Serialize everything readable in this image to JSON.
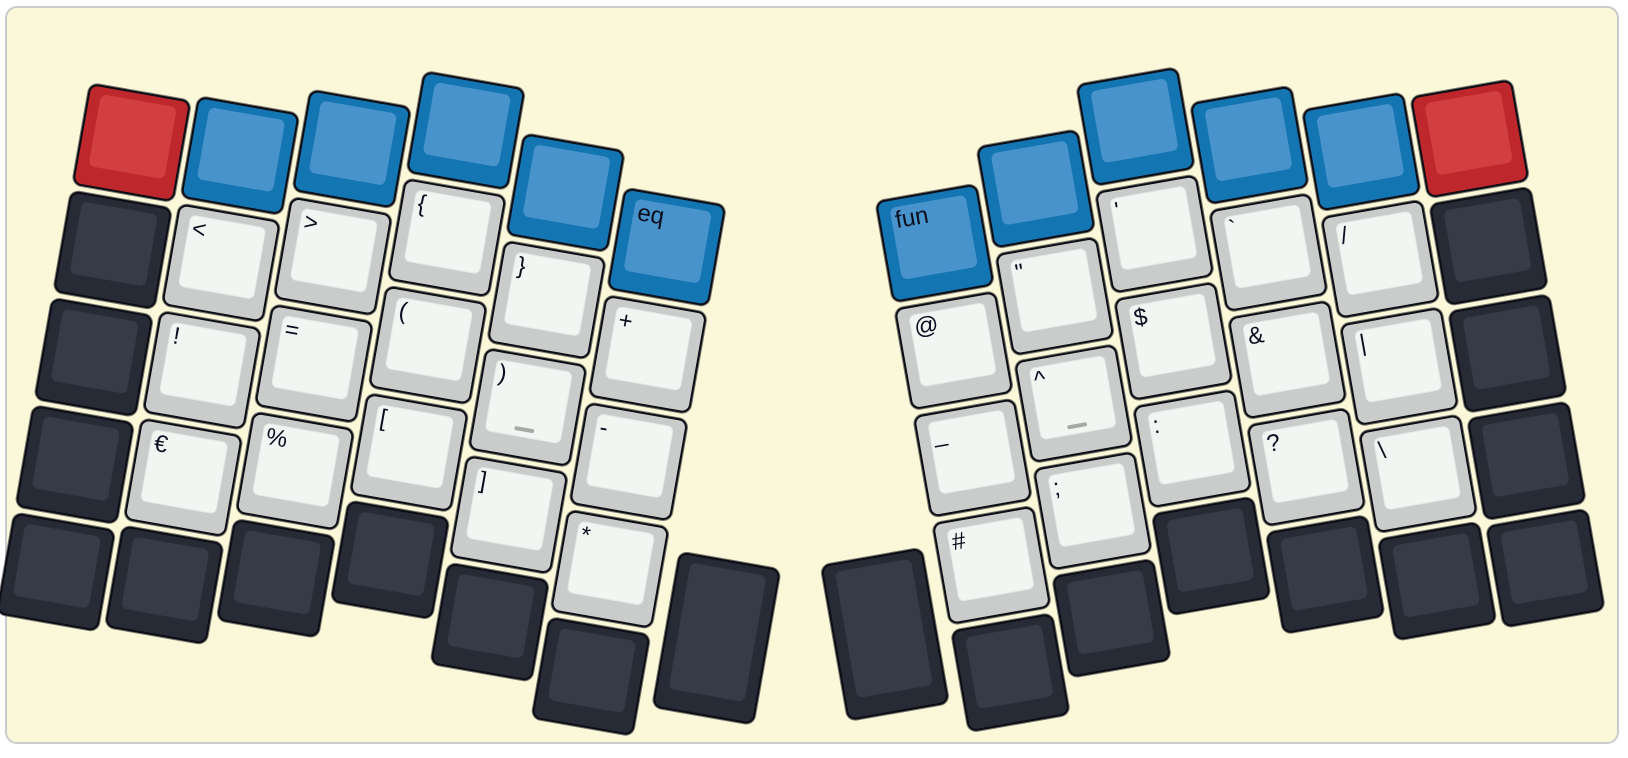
{
  "app": {
    "description": "Split ergonomic keyboard layout diagram (symbols layer), two rotated halves on a pale-yellow keyboard case"
  },
  "case": {
    "fill": "#FBF8D9",
    "border": "#C9CBCE",
    "page_background": "#FFFFFF"
  },
  "key_colors": {
    "blue": {
      "side": "#1375B1",
      "face": "#4893CC"
    },
    "red": {
      "side": "#BE282C",
      "face": "#D23F40"
    },
    "dark": {
      "side": "#262B36",
      "face": "#353C48"
    },
    "white": {
      "side": "#C9CCCA",
      "face": "#F2F6F3"
    }
  },
  "legend_color": "#0B0E1F",
  "homing_bar_color": "#A6A9A5",
  "layout": {
    "unit_px": 109,
    "key_px": 103
  },
  "halves": [
    {
      "name": "left",
      "rotation_deg": 10,
      "origin": {
        "x": 102,
        "y": 14
      },
      "keys": [
        {
          "name": "mod-red-left",
          "color": "red",
          "x": 0,
          "y": 0.64,
          "legend": ""
        },
        {
          "name": "mod-blue-left-1",
          "color": "blue",
          "x": 1,
          "y": 0.59,
          "legend": ""
        },
        {
          "name": "mod-blue-left-2",
          "color": "blue",
          "x": 2,
          "y": 0.35,
          "legend": ""
        },
        {
          "name": "mod-blue-left-3",
          "color": "blue",
          "x": 3,
          "y": 0,
          "legend": ""
        },
        {
          "name": "mod-blue-left-4",
          "color": "blue",
          "x": 4,
          "y": 0.4,
          "legend": ""
        },
        {
          "name": "eq-layer",
          "color": "blue",
          "x": 5,
          "y": 0.73,
          "legend": "eq"
        },
        {
          "name": "blank-dark-left-r1",
          "color": "dark",
          "x": 0,
          "y": 1.64,
          "legend": ""
        },
        {
          "name": "less-than",
          "color": "white",
          "x": 1,
          "y": 1.59,
          "legend": "<"
        },
        {
          "name": "greater-than",
          "color": "white",
          "x": 2,
          "y": 1.35,
          "legend": ">"
        },
        {
          "name": "open-brace",
          "color": "white",
          "x": 3,
          "y": 1,
          "legend": "{"
        },
        {
          "name": "close-brace",
          "color": "white",
          "x": 4,
          "y": 1.4,
          "legend": "}"
        },
        {
          "name": "plus",
          "color": "white",
          "x": 5,
          "y": 1.73,
          "legend": "+"
        },
        {
          "name": "blank-dark-left-r2",
          "color": "dark",
          "x": 0,
          "y": 2.64,
          "legend": ""
        },
        {
          "name": "exclamation",
          "color": "white",
          "x": 1,
          "y": 2.59,
          "legend": "!"
        },
        {
          "name": "equals",
          "color": "white",
          "x": 2,
          "y": 2.35,
          "legend": "="
        },
        {
          "name": "open-paren",
          "color": "white",
          "x": 3,
          "y": 2,
          "legend": "("
        },
        {
          "name": "close-paren-home",
          "color": "white",
          "x": 4,
          "y": 2.4,
          "legend": ")",
          "homing": true
        },
        {
          "name": "minus",
          "color": "white",
          "x": 5,
          "y": 2.73,
          "legend": "-"
        },
        {
          "name": "blank-dark-left-r3",
          "color": "dark",
          "x": 0,
          "y": 3.64,
          "legend": ""
        },
        {
          "name": "euro",
          "color": "white",
          "x": 1,
          "y": 3.59,
          "legend": "€"
        },
        {
          "name": "percent",
          "color": "white",
          "x": 2,
          "y": 3.35,
          "legend": "%"
        },
        {
          "name": "open-bracket",
          "color": "white",
          "x": 3,
          "y": 3,
          "legend": "["
        },
        {
          "name": "close-bracket",
          "color": "white",
          "x": 4,
          "y": 3.4,
          "legend": "]"
        },
        {
          "name": "asterisk",
          "color": "white",
          "x": 5,
          "y": 3.73,
          "legend": "*"
        },
        {
          "name": "blank-dark-left-r4c0",
          "color": "dark",
          "x": 0,
          "y": 4.64,
          "legend": ""
        },
        {
          "name": "blank-dark-left-r4c1",
          "color": "dark",
          "x": 1,
          "y": 4.59,
          "legend": ""
        },
        {
          "name": "blank-dark-left-r4c2",
          "color": "dark",
          "x": 2,
          "y": 4.35,
          "legend": ""
        },
        {
          "name": "blank-dark-left-r4c3",
          "color": "dark",
          "x": 3,
          "y": 4,
          "legend": ""
        },
        {
          "name": "blank-dark-left-r4c4",
          "color": "dark",
          "x": 4,
          "y": 4.4,
          "legend": ""
        },
        {
          "name": "blank-dark-left-r4c5",
          "color": "dark",
          "x": 5,
          "y": 4.73,
          "legend": ""
        },
        {
          "name": "thumb-tall-left",
          "color": "dark",
          "x": 6.07,
          "y": 3.94,
          "h": 1.5,
          "legend": ""
        }
      ]
    },
    {
      "name": "right",
      "rotation_deg": -10,
      "origin": {
        "x": 746,
        "y": 143
      },
      "keys": [
        {
          "name": "fun-layer",
          "color": "blue",
          "x": 1.07,
          "y": 0.73,
          "legend": "fun"
        },
        {
          "name": "mod-blue-right-1",
          "color": "blue",
          "x": 2.07,
          "y": 0.4,
          "legend": ""
        },
        {
          "name": "mod-blue-right-2",
          "color": "blue",
          "x": 3.07,
          "y": 0,
          "legend": ""
        },
        {
          "name": "mod-blue-right-3",
          "color": "blue",
          "x": 4.07,
          "y": 0.35,
          "legend": ""
        },
        {
          "name": "mod-blue-right-4",
          "color": "blue",
          "x": 5.07,
          "y": 0.59,
          "legend": ""
        },
        {
          "name": "mod-red-right",
          "color": "red",
          "x": 6.07,
          "y": 0.64,
          "legend": ""
        },
        {
          "name": "at-sign",
          "color": "white",
          "x": 1.07,
          "y": 1.73,
          "legend": "@"
        },
        {
          "name": "double-quote",
          "color": "white",
          "x": 2.07,
          "y": 1.4,
          "legend": "\""
        },
        {
          "name": "apostrophe",
          "color": "white",
          "x": 3.07,
          "y": 1,
          "legend": "'"
        },
        {
          "name": "backtick",
          "color": "white",
          "x": 4.07,
          "y": 1.35,
          "legend": "`"
        },
        {
          "name": "slash",
          "color": "white",
          "x": 5.07,
          "y": 1.59,
          "legend": "/"
        },
        {
          "name": "blank-dark-right-r1",
          "color": "dark",
          "x": 6.07,
          "y": 1.64,
          "legend": ""
        },
        {
          "name": "underscore",
          "color": "white",
          "x": 1.07,
          "y": 2.73,
          "legend": "_"
        },
        {
          "name": "caret-home",
          "color": "white",
          "x": 2.07,
          "y": 2.4,
          "legend": "^",
          "homing": true
        },
        {
          "name": "dollar",
          "color": "white",
          "x": 3.07,
          "y": 2,
          "legend": "$"
        },
        {
          "name": "ampersand",
          "color": "white",
          "x": 4.07,
          "y": 2.35,
          "legend": "&"
        },
        {
          "name": "pipe",
          "color": "white",
          "x": 5.07,
          "y": 2.59,
          "legend": "|"
        },
        {
          "name": "blank-dark-right-r2",
          "color": "dark",
          "x": 6.07,
          "y": 2.64,
          "legend": ""
        },
        {
          "name": "hash",
          "color": "white",
          "x": 1.07,
          "y": 3.73,
          "legend": "#"
        },
        {
          "name": "semicolon",
          "color": "white",
          "x": 2.07,
          "y": 3.4,
          "legend": ";"
        },
        {
          "name": "colon",
          "color": "white",
          "x": 3.07,
          "y": 3,
          "legend": ":"
        },
        {
          "name": "question",
          "color": "white",
          "x": 4.07,
          "y": 3.35,
          "legend": "?"
        },
        {
          "name": "backslash",
          "color": "white",
          "x": 5.07,
          "y": 3.59,
          "legend": "\\"
        },
        {
          "name": "blank-dark-right-r3",
          "color": "dark",
          "x": 6.07,
          "y": 3.64,
          "legend": ""
        },
        {
          "name": "thumb-tall-right",
          "color": "dark",
          "x": 0,
          "y": 3.94,
          "h": 1.5,
          "legend": ""
        },
        {
          "name": "blank-dark-right-r4c1",
          "color": "dark",
          "x": 1.07,
          "y": 4.73,
          "legend": ""
        },
        {
          "name": "blank-dark-right-r4c2",
          "color": "dark",
          "x": 2.07,
          "y": 4.4,
          "legend": ""
        },
        {
          "name": "blank-dark-right-r4c3",
          "color": "dark",
          "x": 3.07,
          "y": 4,
          "legend": ""
        },
        {
          "name": "blank-dark-right-r4c4",
          "color": "dark",
          "x": 4.07,
          "y": 4.35,
          "legend": ""
        },
        {
          "name": "blank-dark-right-r4c5",
          "color": "dark",
          "x": 5.07,
          "y": 4.59,
          "legend": ""
        },
        {
          "name": "blank-dark-right-r4c6",
          "color": "dark",
          "x": 6.07,
          "y": 4.64,
          "legend": ""
        }
      ]
    }
  ]
}
